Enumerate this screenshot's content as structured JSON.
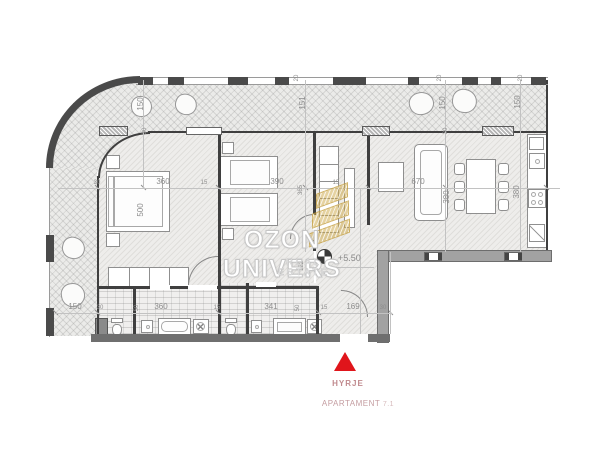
{
  "watermark": {
    "title": "OZON UNIVERS",
    "subtitle": "REAL ESTATE",
    "logo": "gold-building-logo"
  },
  "level_marker": {
    "value": "+5.50",
    "symbol": "benchmark-icon"
  },
  "entry": {
    "label": "HYRJE",
    "apartment_label": "APARTAMENT",
    "apartment_number": "7.1",
    "arrow_color": "#e0151b",
    "text_color": "#c08a8e"
  },
  "dimensions": {
    "d150": "150",
    "d151": "151",
    "d20": "20",
    "d30": "30",
    "d15": "15",
    "d50": "50",
    "d360": "360",
    "d390": "390",
    "d500": "500",
    "d365": "365",
    "d122": "122",
    "d670": "670",
    "d380": "380",
    "d341": "341",
    "d169": "169"
  },
  "colors": {
    "wall_dark": "#4a4a4a",
    "structural_gray": "#a2a2a2",
    "dimension_text": "#8d8d8d",
    "watermark_gold": "#cca642",
    "floor_tint": "#eeedeb"
  }
}
